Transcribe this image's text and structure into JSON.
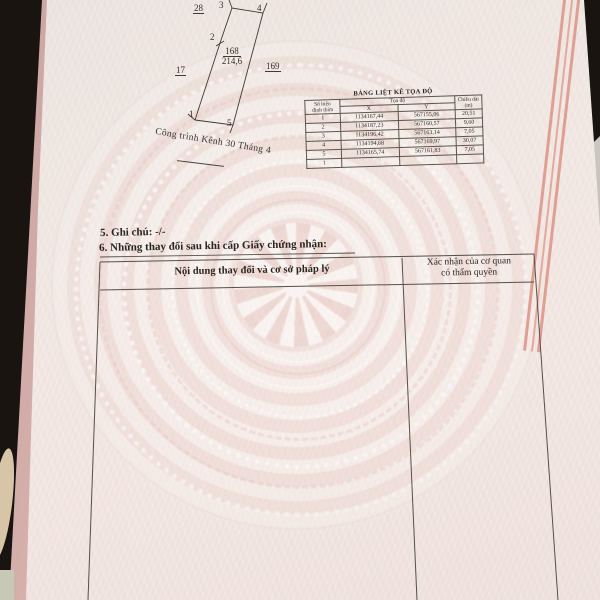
{
  "document": {
    "sketch": {
      "adjacent_top": "28",
      "adjacent_left": "17",
      "adjacent_right": "169",
      "parcel_number": "168",
      "parcel_area": "214,6",
      "vertices": [
        "1",
        "2",
        "3",
        "4",
        "5"
      ],
      "canal_label": "Công trình Kênh 30 Tháng 4"
    },
    "coord_table": {
      "title": "BẢNG LIỆT KÊ TỌA ĐỘ",
      "header_vertex": "Số hiệu\nđỉnh thửa",
      "header_coords": "Tọa độ",
      "header_x": "X",
      "header_y": "Y",
      "header_length": "Chiều dài\n(m)",
      "rows": [
        {
          "v": "1",
          "x": "1134167,44",
          "y": "567155,06",
          "l": "20,51"
        },
        {
          "v": "2",
          "x": "1134187,23",
          "y": "567160,57",
          "l": "9,60"
        },
        {
          "v": "3",
          "x": "1134196,42",
          "y": "567163,14",
          "l": "7,05"
        },
        {
          "v": "4",
          "x": "1134194,68",
          "y": "567169,97",
          "l": "30,07"
        },
        {
          "v": "5",
          "x": "1134165,74",
          "y": "567161,83",
          "l": "7,05"
        },
        {
          "v": "1",
          "x": "",
          "y": "",
          "l": ""
        }
      ]
    },
    "section_note": "5. Ghi chú: -/-",
    "section_changes": "6. Những thay đổi sau khi cấp Giấy chứng nhận:",
    "changes_table": {
      "header_content": "Nội dung thay đổi và cơ sở pháp lý",
      "header_confirm": "Xác nhận của cơ quan\ncó thẩm quyền"
    },
    "colors": {
      "paper": "#f0e8e3",
      "guilloche_pink": "#e9cfc9",
      "border_salmon": "#df9f93",
      "ink": "#2f2a24",
      "background": "#191410"
    }
  }
}
